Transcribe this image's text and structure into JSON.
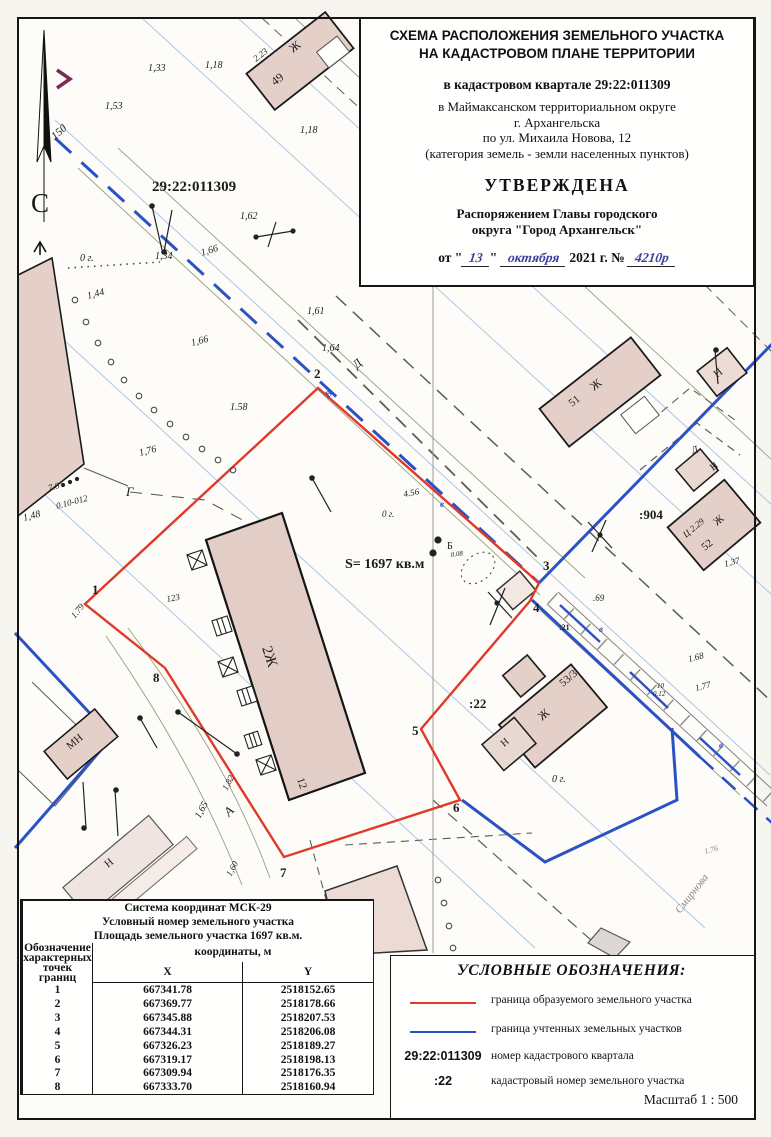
{
  "title_block": {
    "line1": "СХЕМА РАСПОЛОЖЕНИЯ ЗЕМЕЛЬНОГО УЧАСТКА",
    "line2": "НА КАДАСТРОВОМ ПЛАНЕ ТЕРРИТОРИИ",
    "quarter": "в кадастровом квартале 29:22:011309",
    "addr1": "в  Маймаксанском территориальном округе",
    "addr2": "г. Архангельска",
    "addr3": "по ул. Михаила Новова, 12",
    "addr4": "(категория земель - земли населенных пунктов)",
    "approved": "УТВЕРЖДЕНА",
    "order1": "Распоряжением Главы городского",
    "order2": "округа \"Город Архангельск\"",
    "approval": {
      "p1": "от \"",
      "day": "13",
      "p2": "\"",
      "month": "октября",
      "p3": "2021 г. №",
      "num": "4210р"
    }
  },
  "table": {
    "h1": "Система координат МСК-29",
    "h2": "Условный номер земельного участка",
    "h3": "Площадь земельного участка 1697 кв.м.",
    "col_points": "Обозначение характерных точек границ",
    "coords_header": "координаты, м",
    "col_x": "X",
    "col_y": "Y",
    "rows": [
      [
        "1",
        "667341.78",
        "2518152.65"
      ],
      [
        "2",
        "667369.77",
        "2518178.66"
      ],
      [
        "3",
        "667345.88",
        "2518207.53"
      ],
      [
        "4",
        "667344.31",
        "2518206.08"
      ],
      [
        "5",
        "667326.23",
        "2518189.27"
      ],
      [
        "6",
        "667319.17",
        "2518198.13"
      ],
      [
        "7",
        "667309.94",
        "2518176.35"
      ],
      [
        "8",
        "667333.70",
        "2518160.94"
      ]
    ]
  },
  "legend": {
    "title": "УСЛОВНЫЕ ОБОЗНАЧЕНИЯ:",
    "items": [
      {
        "symbol": "red-line",
        "label": "граница образуемого земельного участка"
      },
      {
        "symbol": "blue-line",
        "label": "граница учтенных земельных участков"
      },
      {
        "symbol": "29:22:011309",
        "label": "номер кадастрового квартала"
      },
      {
        "symbol": ":22",
        "label": "кадастровый номер земельного участка"
      }
    ],
    "scale": "Масштаб  1 : 500",
    "colors": {
      "formed_boundary": "#e0392a",
      "registered_boundary": "#2b52c4"
    }
  },
  "map": {
    "labels": [
      {
        "t": "С",
        "x": 31,
        "y": 212,
        "s": 27,
        "i": false
      },
      {
        "t": "150",
        "x": 55,
        "y": 140,
        "r": -42,
        "s": 11
      },
      {
        "t": "29:22:011309",
        "x": 152,
        "y": 191,
        "s": 15,
        "b": true,
        "i": false
      },
      {
        "t": "1,33",
        "x": 148,
        "y": 71
      },
      {
        "t": "1,18",
        "x": 205,
        "y": 68
      },
      {
        "t": "2.23",
        "x": 256,
        "y": 62,
        "r": -38,
        "s": 9
      },
      {
        "t": "Ж",
        "x": 293,
        "y": 53,
        "r": -38,
        "s": 12,
        "i": false
      },
      {
        "t": "49",
        "x": 275,
        "y": 86,
        "r": -38,
        "s": 12,
        "i": false
      },
      {
        "t": "1,53",
        "x": 105,
        "y": 109
      },
      {
        "t": "1,18",
        "x": 300,
        "y": 133
      },
      {
        "t": "1,62",
        "x": 240,
        "y": 219
      },
      {
        "t": "1,34",
        "x": 155,
        "y": 259
      },
      {
        "t": "1,66",
        "x": 202,
        "y": 256,
        "r": -18
      },
      {
        "t": "0 г.",
        "x": 80,
        "y": 261
      },
      {
        "t": "1,44",
        "x": 88,
        "y": 299,
        "r": -15
      },
      {
        "t": "1,66",
        "x": 192,
        "y": 346,
        "r": -15
      },
      {
        "t": "1,76",
        "x": 140,
        "y": 456,
        "r": -15
      },
      {
        "t": "7.0",
        "x": 49,
        "y": 491,
        "r": -15,
        "s": 9
      },
      {
        "t": "0.10-012",
        "x": 57,
        "y": 509,
        "r": -15,
        "s": 9
      },
      {
        "t": "1,48",
        "x": 24,
        "y": 521,
        "r": -15
      },
      {
        "t": "Г",
        "x": 126,
        "y": 496,
        "s": 13
      },
      {
        "t": "1.58",
        "x": 230,
        "y": 410
      },
      {
        "t": "1,61",
        "x": 307,
        "y": 314
      },
      {
        "t": "1,64",
        "x": 322,
        "y": 351
      },
      {
        "t": "Д",
        "x": 357,
        "y": 369,
        "r": -42,
        "s": 12
      },
      {
        "t": "2",
        "x": 314,
        "y": 378,
        "s": 13,
        "b": true,
        "i": false
      },
      {
        "t": "В",
        "x": 328,
        "y": 398,
        "r": -40,
        "s": 9,
        "c": "#2b52c4",
        "b": true
      },
      {
        "t": "в",
        "x": 440,
        "y": 507,
        "s": 9,
        "c": "#2b52c4",
        "b": true
      },
      {
        "t": "4.56",
        "x": 404,
        "y": 497,
        "r": -10,
        "s": 9
      },
      {
        "t": "0 г.",
        "x": 382,
        "y": 517,
        "s": 9
      },
      {
        "t": "S= 1697 кв.м",
        "x": 345,
        "y": 568,
        "s": 14,
        "b": true,
        "i": false
      },
      {
        "t": "1",
        "x": 92,
        "y": 594,
        "s": 13,
        "b": true,
        "i": false
      },
      {
        "t": "1.79",
        "x": 75,
        "y": 619,
        "r": -52,
        "s": 9
      },
      {
        "t": "8",
        "x": 153,
        "y": 682,
        "s": 13,
        "b": true,
        "i": false
      },
      {
        "t": "5",
        "x": 412,
        "y": 735,
        "s": 13,
        "b": true,
        "i": false
      },
      {
        "t": "6",
        "x": 453,
        "y": 812,
        "s": 13,
        "b": true,
        "i": false
      },
      {
        "t": "7",
        "x": 280,
        "y": 877,
        "s": 13,
        "b": true,
        "i": false
      },
      {
        "t": "3",
        "x": 543,
        "y": 570,
        "s": 13,
        "b": true,
        "i": false
      },
      {
        "t": "4",
        "x": 533,
        "y": 612,
        "s": 13,
        "b": true,
        "i": false
      },
      {
        "t": "123",
        "x": 167,
        "y": 602,
        "s": 9,
        "r": -10
      },
      {
        "t": "2Ж",
        "x": 262,
        "y": 648,
        "r": 72,
        "s": 15,
        "i": false
      },
      {
        "t": "12",
        "x": 297,
        "y": 779,
        "r": 72,
        "s": 11,
        "i": false
      },
      {
        "t": "1,82",
        "x": 227,
        "y": 791,
        "r": -62,
        "s": 9
      },
      {
        "t": "1,65",
        "x": 200,
        "y": 819,
        "r": -62
      },
      {
        "t": "А",
        "x": 229,
        "y": 817,
        "r": -45,
        "s": 13
      },
      {
        "t": "1,60",
        "x": 231,
        "y": 877,
        "r": -62,
        "s": 9
      },
      {
        "t": "МН",
        "x": 70,
        "y": 750,
        "r": -40,
        "s": 11,
        "i": false
      },
      {
        "t": "Н",
        "x": 108,
        "y": 868,
        "r": -40,
        "s": 11,
        "i": false
      },
      {
        "t": "Ж",
        "x": 594,
        "y": 391,
        "r": -38,
        "s": 12,
        "i": false
      },
      {
        "t": "51",
        "x": 572,
        "y": 407,
        "r": -38,
        "s": 11,
        "i": false
      },
      {
        "t": "Н",
        "x": 717,
        "y": 378,
        "r": -38,
        "s": 11,
        "i": false
      },
      {
        "t": ":904",
        "x": 639,
        "y": 519,
        "s": 13,
        "b": true,
        "i": false
      },
      {
        "t": "Н",
        "x": 713,
        "y": 471,
        "r": -38,
        "s": 10,
        "i": false
      },
      {
        "t": "Ц 2.29",
        "x": 686,
        "y": 538,
        "r": -40,
        "s": 9
      },
      {
        "t": "Ж",
        "x": 717,
        "y": 526,
        "r": -40,
        "s": 11,
        "i": false
      },
      {
        "t": "52",
        "x": 705,
        "y": 551,
        "r": -40,
        "s": 11,
        "i": false
      },
      {
        "t": "1.37",
        "x": 725,
        "y": 567,
        "r": -15,
        "s": 9
      },
      {
        "t": "Д",
        "x": 693,
        "y": 453,
        "r": -20,
        "s": 9
      },
      {
        "t": "Б",
        "x": 447,
        "y": 549,
        "s": 10,
        "i": false
      },
      {
        "t": "0.08",
        "x": 451,
        "y": 557,
        "s": 7,
        "r": -8
      },
      {
        "t": ":22",
        "x": 469,
        "y": 708,
        "s": 13,
        "b": true,
        "i": false
      },
      {
        "t": "Ж",
        "x": 542,
        "y": 721,
        "r": -40,
        "s": 12,
        "i": false
      },
      {
        "t": "53/3",
        "x": 563,
        "y": 687,
        "r": -40,
        "s": 11,
        "i": false
      },
      {
        "t": "Н",
        "x": 504,
        "y": 747,
        "r": -40,
        "s": 10,
        "i": false
      },
      {
        "t": "0 г.",
        "x": 552,
        "y": 782,
        "s": 10
      },
      {
        "t": ":21",
        "x": 559,
        "y": 630,
        "s": 8,
        "b": true,
        "i": false
      },
      {
        "t": ".69",
        "x": 593,
        "y": 601,
        "s": 9
      },
      {
        "t": "в",
        "x": 599,
        "y": 632,
        "s": 9,
        "c": "#2b52c4",
        "b": true
      },
      {
        "t": "1.68",
        "x": 689,
        "y": 662,
        "r": -15,
        "s": 9
      },
      {
        "t": "1.77",
        "x": 696,
        "y": 691,
        "r": -15,
        "s": 9
      },
      {
        "t": "10",
        "x": 657,
        "y": 688,
        "s": 7
      },
      {
        "t": "0.12",
        "x": 653,
        "y": 696,
        "s": 7
      },
      {
        "t": "в",
        "x": 719,
        "y": 748,
        "s": 9,
        "c": "#2b52c4",
        "b": true
      },
      {
        "t": "Смирнова",
        "x": 680,
        "y": 914,
        "r": -52,
        "s": 11,
        "c": "#8b887e"
      },
      {
        "t": "1.76",
        "x": 705,
        "y": 854,
        "r": -15,
        "s": 8,
        "c": "#8b887e"
      }
    ]
  }
}
